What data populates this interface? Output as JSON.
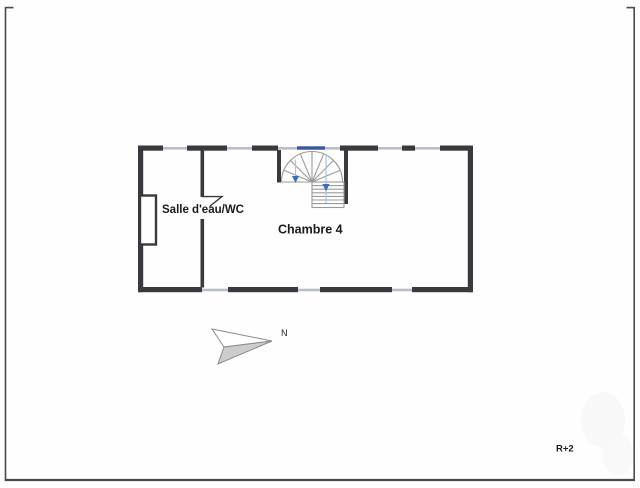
{
  "page": {
    "background": "#fefefe",
    "frame_color": "#4a4a4e"
  },
  "floor_plan": {
    "level_label": "R+2",
    "rooms": [
      {
        "name": "Salle d'eau/WC"
      },
      {
        "name": "Chambre 4"
      }
    ],
    "compass": {
      "label": "N"
    },
    "features": {
      "staircase": "spiral-staircase-with-straight-flight",
      "windows_top_wall": 5,
      "windows_bottom_wall": 3
    },
    "colors": {
      "wall": "#3a3a3e",
      "window_line": "#b7bdca",
      "window_blue": "#3b55a0",
      "stair_line": "#9a9a9a",
      "stair_arrow_blue": "#3f6db4",
      "stair_walkline_blue": "#a9c3e0",
      "compass_fill": "#cccccc",
      "compass_stroke": "#8a8a8a",
      "text": "#1a1a1a"
    }
  }
}
